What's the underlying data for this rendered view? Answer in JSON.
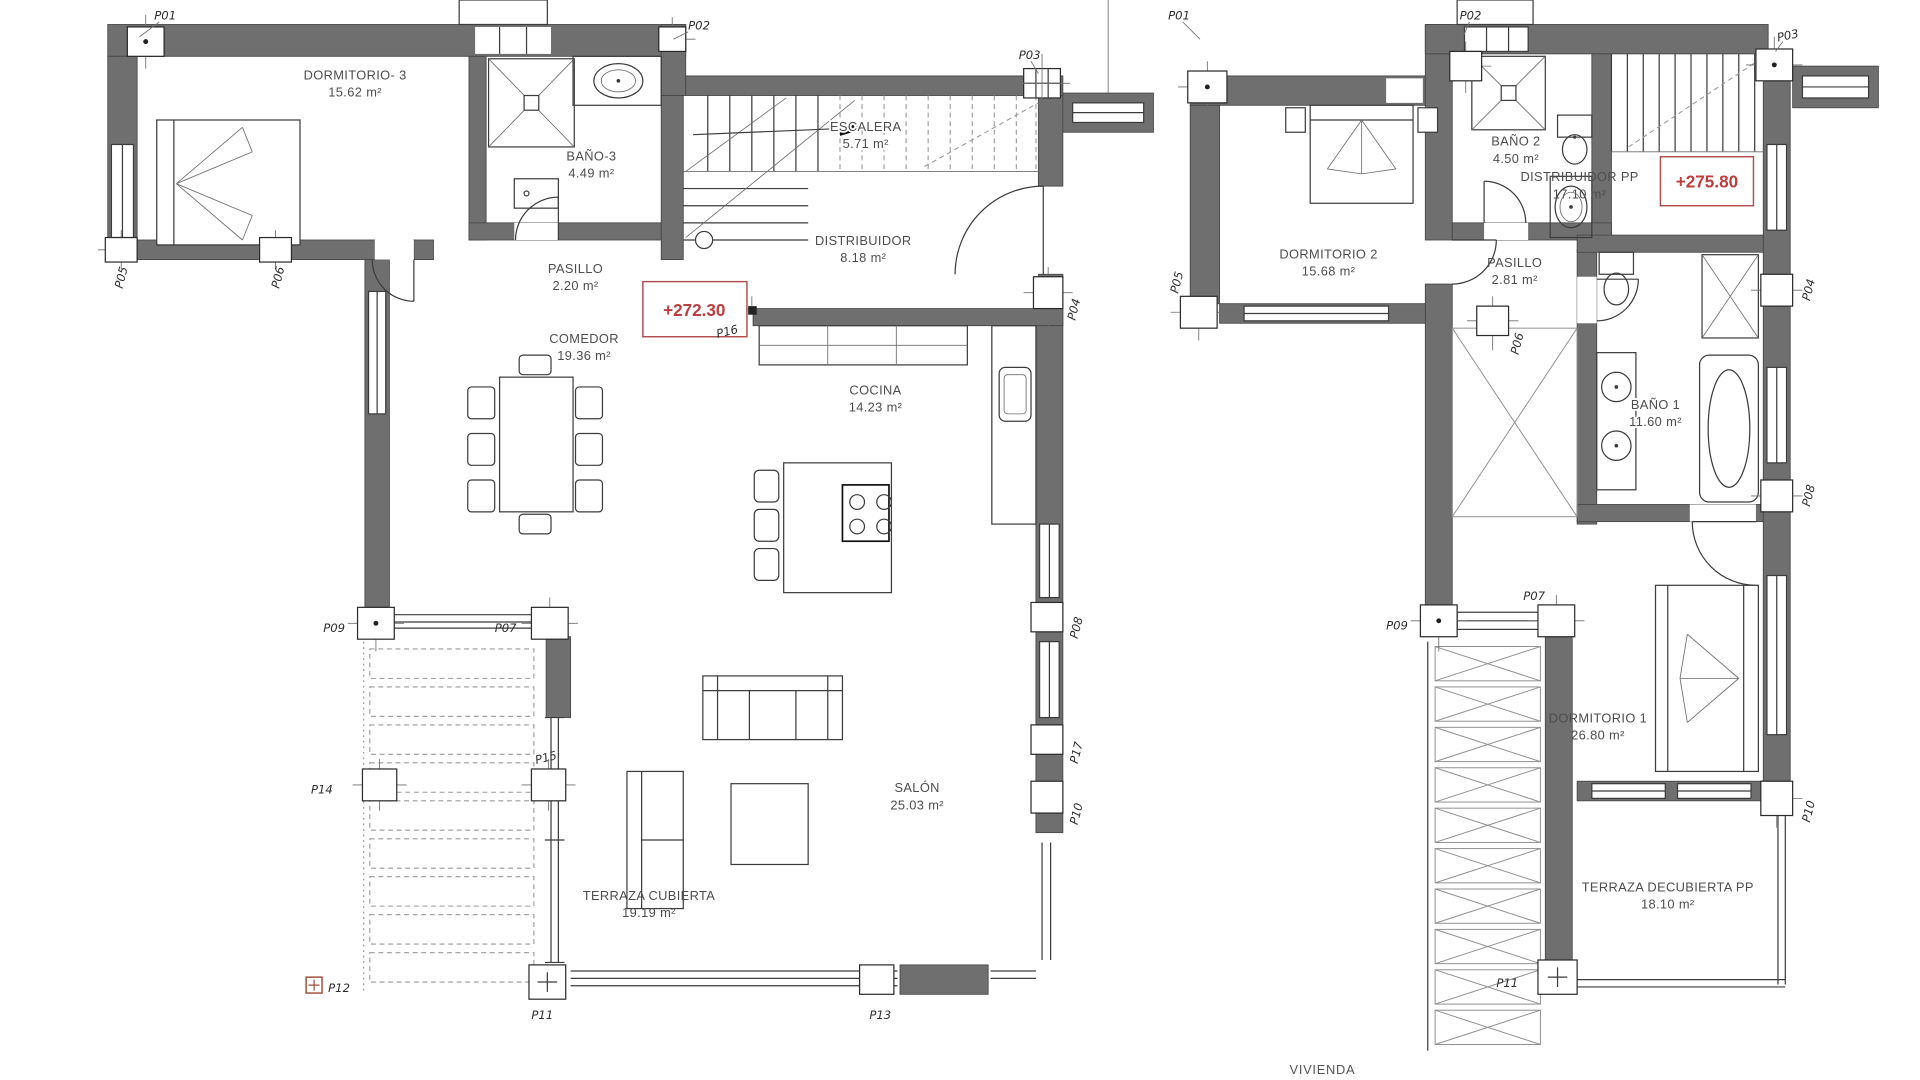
{
  "ground_floor": {
    "rooms": [
      {
        "name": "DORMITORIO- 3",
        "area": "15.62 m²"
      },
      {
        "name": "BAÑO-3",
        "area": "4.49 m²"
      },
      {
        "name": "ESCALERA",
        "area": "5.71 m²"
      },
      {
        "name": "DISTRIBUIDOR",
        "area": "8.18 m²"
      },
      {
        "name": "PASILLO",
        "area": "2.20 m²"
      },
      {
        "name": "COMEDOR",
        "area": "19.36 m²"
      },
      {
        "name": "COCINA",
        "area": "14.23 m²"
      },
      {
        "name": "SALÓN",
        "area": "25.03 m²"
      },
      {
        "name": "TERRAZA CUBIERTA",
        "area": "19.19 m²"
      }
    ],
    "level_mark": "+272.30",
    "pillars": {
      "p01": "P01",
      "p02": "P02",
      "p03": "P03",
      "p04": "P04",
      "p05": "P05",
      "p06": "P06",
      "p07": "P07",
      "p08": "P08",
      "p09": "P09",
      "p10": "P10",
      "p11": "P11",
      "p12": "P12",
      "p13": "P13",
      "p14": "P14",
      "p15": "P15",
      "p16": "P16",
      "p17": "P17"
    }
  },
  "upper_floor": {
    "rooms": [
      {
        "name": "DORMITORIO 2",
        "area": "15.68 m²"
      },
      {
        "name": "BAÑO 2",
        "area": "4.50 m²"
      },
      {
        "name": "DISTRIBUIDOR PP",
        "area": "17.10 m²"
      },
      {
        "name": "PASILLO",
        "area": "2.81 m²"
      },
      {
        "name": "BAÑO 1",
        "area": "11.60 m²"
      },
      {
        "name": "DORMITORIO 1",
        "area": "26.80 m²"
      },
      {
        "name": "TERRAZA DECUBIERTA PP",
        "area": "18.10 m²"
      }
    ],
    "level_mark": "+275.80",
    "pillars": {
      "p01": "P01",
      "p02": "P02",
      "p03": "P03",
      "p04": "P04",
      "p05": "P05",
      "p06": "P06",
      "p07": "P07",
      "p08": "P08",
      "p09": "P09",
      "p10": "P10",
      "p11": "P11"
    }
  },
  "footer": {
    "caption": "VIVIENDA"
  },
  "colors": {
    "wall_gray": "#6f6f6f",
    "line_dark": "#3c3c3c",
    "level_red": "#bc3e3e",
    "label_gray": "#4d4d4d"
  }
}
